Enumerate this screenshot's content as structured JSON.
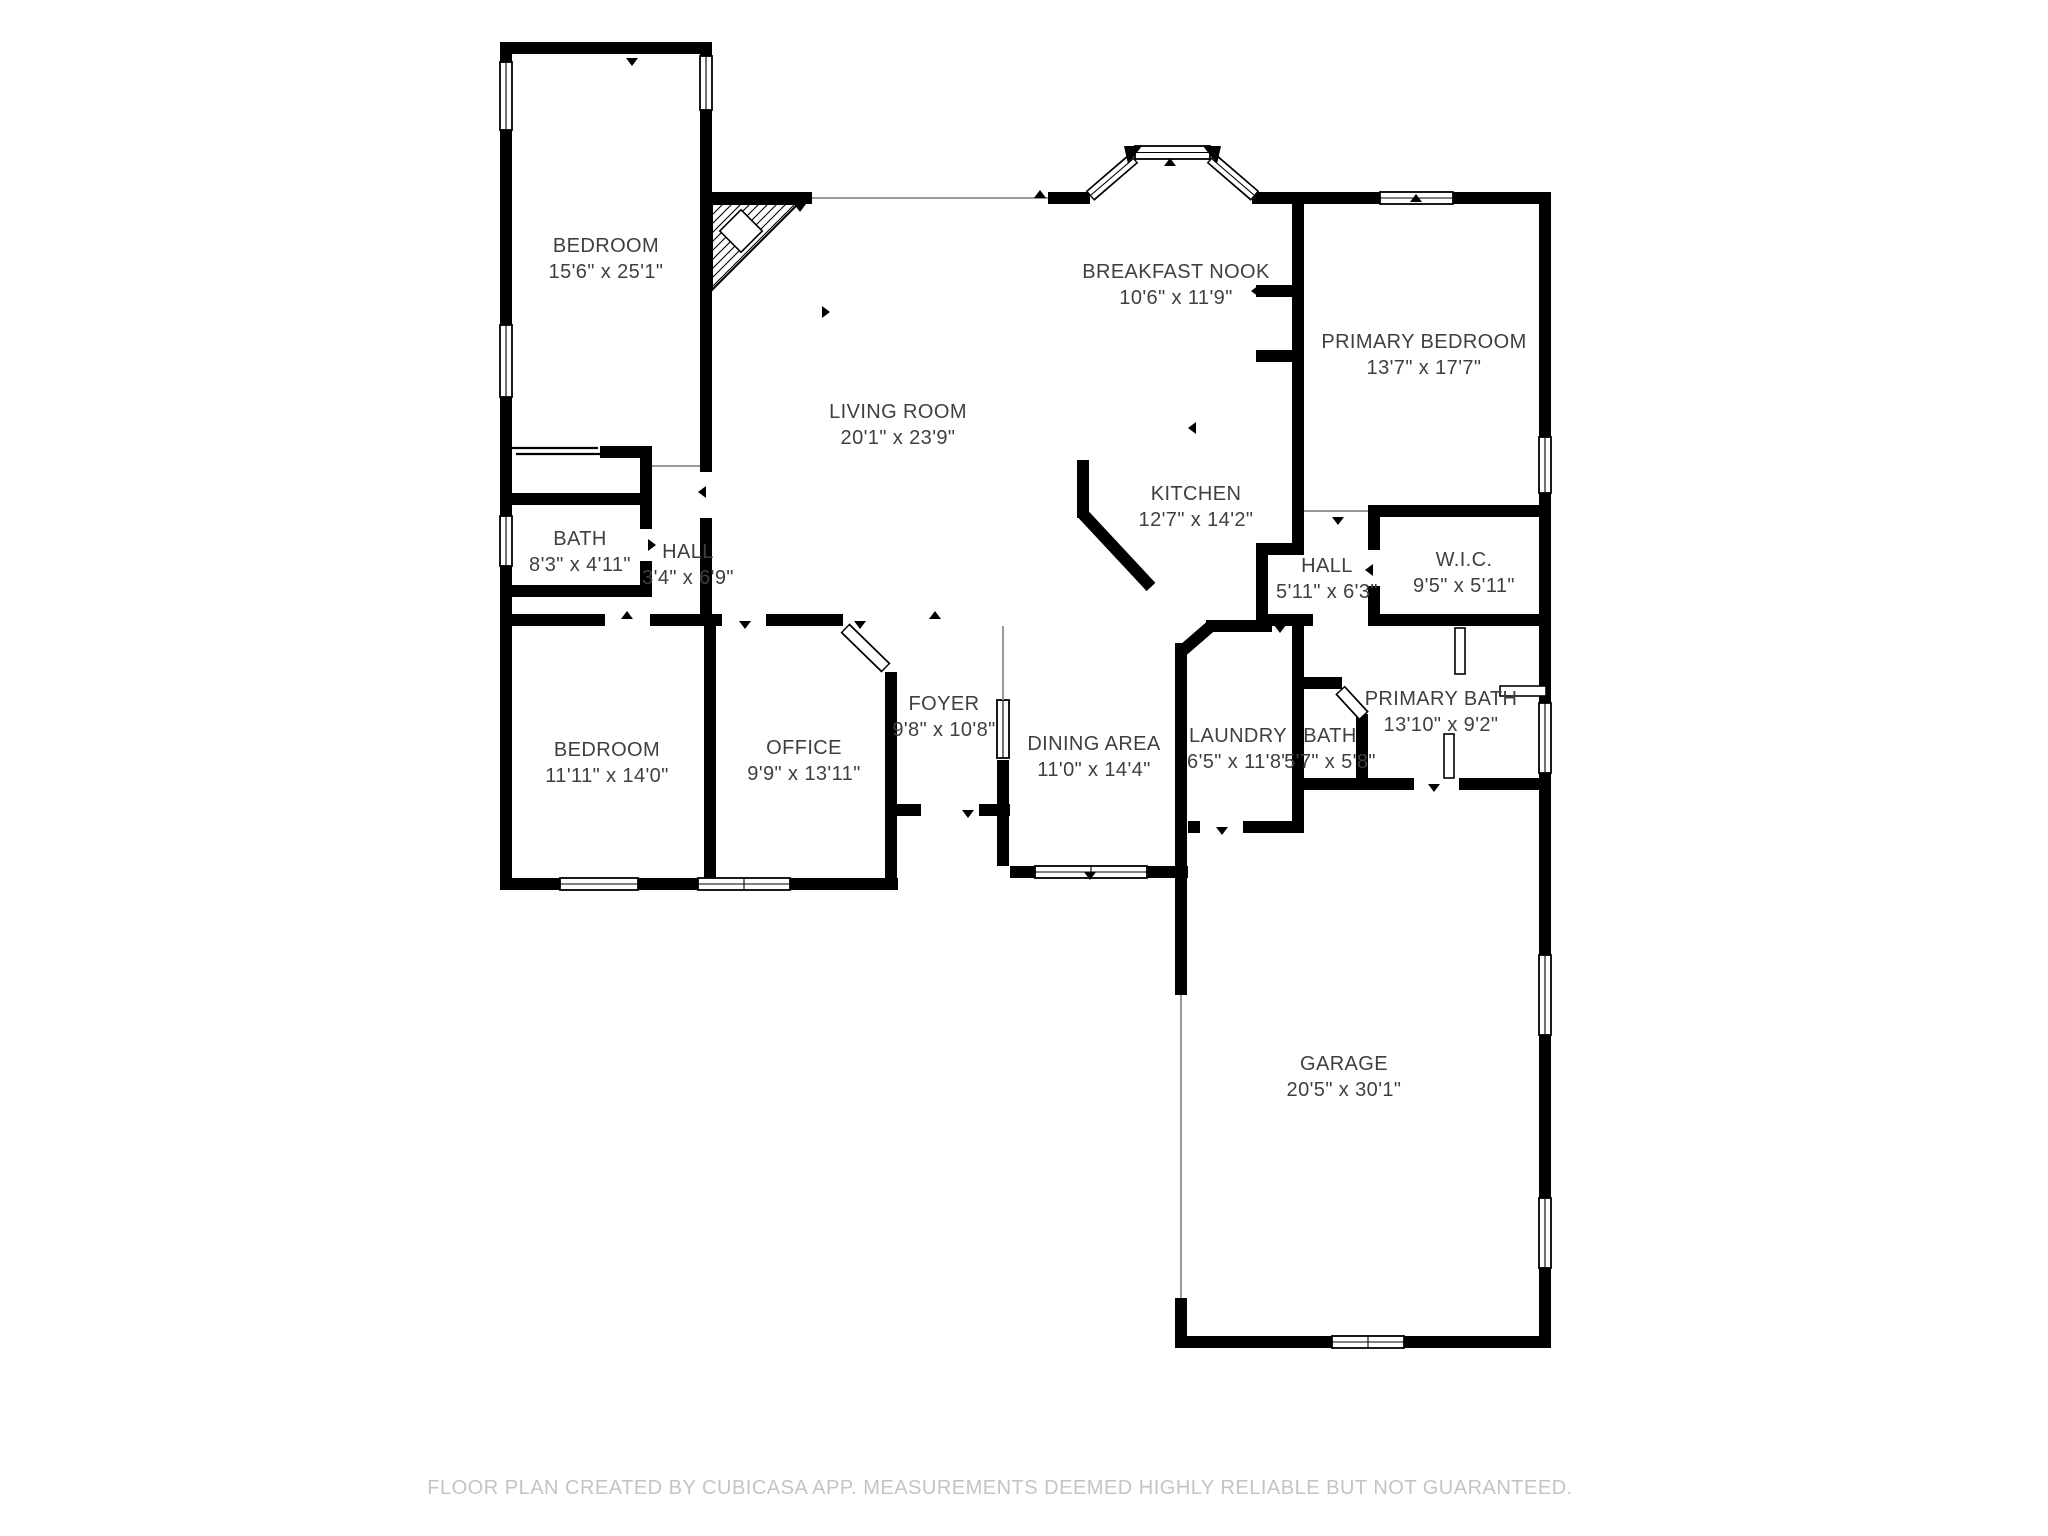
{
  "page": {
    "background": "#ffffff",
    "type": "floor-plan"
  },
  "colors": {
    "wall": "#000000",
    "label": "#3f3f3f",
    "footer": "#c4c4c4",
    "opening_line": "#9a9a9a"
  },
  "footer": {
    "text": "FLOOR PLAN CREATED BY CUBICASA APP. MEASUREMENTS DEEMED HIGHLY RELIABLE BUT NOT GUARANTEED."
  },
  "rooms": [
    {
      "id": "bedroom-upper",
      "name": "BEDROOM",
      "dims": "15'6\" x 25'1\"",
      "x": 606,
      "y": 252
    },
    {
      "id": "breakfast-nook",
      "name": "BREAKFAST NOOK",
      "dims": "10'6\" x 11'9\"",
      "x": 1176,
      "y": 278
    },
    {
      "id": "primary-bedroom",
      "name": "PRIMARY BEDROOM",
      "dims": "13'7\" x 17'7\"",
      "x": 1424,
      "y": 348
    },
    {
      "id": "living-room",
      "name": "LIVING ROOM",
      "dims": "20'1\" x 23'9\"",
      "x": 898,
      "y": 418
    },
    {
      "id": "kitchen",
      "name": "KITCHEN",
      "dims": "12'7\" x 14'2\"",
      "x": 1196,
      "y": 500
    },
    {
      "id": "bath",
      "name": "BATH",
      "dims": "8'3\" x 4'11\"",
      "x": 580,
      "y": 545
    },
    {
      "id": "hall",
      "name": "HALL",
      "dims": "3'4\" x 6'9\"",
      "x": 688,
      "y": 558
    },
    {
      "id": "hall-2",
      "name": "HALL",
      "dims": "5'11\" x 6'3\"",
      "x": 1327,
      "y": 572
    },
    {
      "id": "wic",
      "name": "W.I.C.",
      "dims": "9'5\" x 5'11\"",
      "x": 1464,
      "y": 566
    },
    {
      "id": "bedroom-lower",
      "name": "BEDROOM",
      "dims": "11'11\" x 14'0\"",
      "x": 607,
      "y": 756
    },
    {
      "id": "office",
      "name": "OFFICE",
      "dims": "9'9\" x 13'11\"",
      "x": 804,
      "y": 754
    },
    {
      "id": "foyer",
      "name": "FOYER",
      "dims": "9'8\" x 10'8\"",
      "x": 944,
      "y": 710
    },
    {
      "id": "dining-area",
      "name": "DINING AREA",
      "dims": "11'0\" x 14'4\"",
      "x": 1094,
      "y": 750
    },
    {
      "id": "laundry",
      "name": "LAUNDRY",
      "dims": "6'5\" x 11'8\"",
      "x": 1238,
      "y": 742
    },
    {
      "id": "bath-2",
      "name": "BATH",
      "dims": "5'7\" x 5'8\"",
      "x": 1330,
      "y": 742
    },
    {
      "id": "primary-bath",
      "name": "PRIMARY BATH",
      "dims": "13'10\" x 9'2\"",
      "x": 1441,
      "y": 705
    },
    {
      "id": "garage",
      "name": "GARAGE",
      "dims": "20'5\" x 30'1\"",
      "x": 1344,
      "y": 1070
    }
  ]
}
